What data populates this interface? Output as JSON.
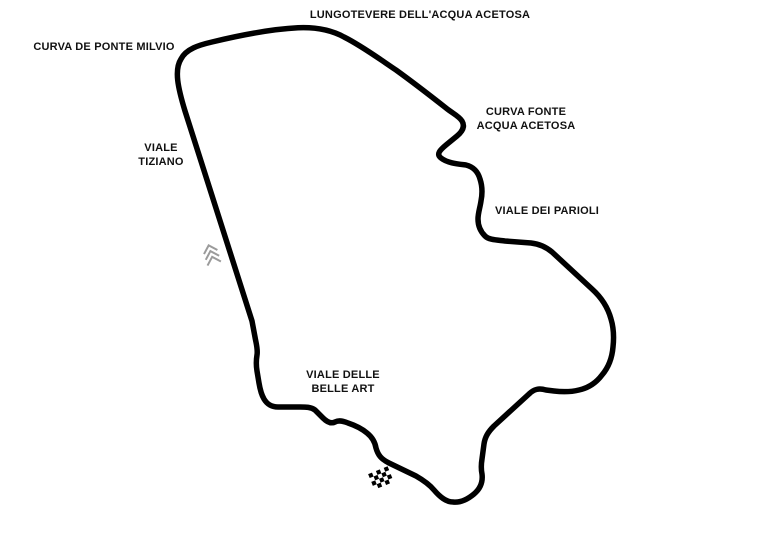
{
  "labels": {
    "lungotevere": "LUNGOTEVERE DELL'ACQUA ACETOSA",
    "ponte_milvio": "CURVA DE PONTE MILVIO",
    "fonte_acetosa": "CURVA FONTE\nACQUA ACETOSA",
    "tiziano": "VIALE\nTIZIANO",
    "parioli": "VIALE DEI PARIOLI",
    "belle_arti": "VIALE DELLE\nBELLE ART"
  },
  "icons": {
    "direction_chevrons": "triple-chevron-direction-marker",
    "finish_flag": "checkered-start-finish-flag"
  },
  "colors": {
    "track": "#000000",
    "chevron": "#9b9b9b",
    "label_text": "#111111",
    "background": "#ffffff"
  }
}
